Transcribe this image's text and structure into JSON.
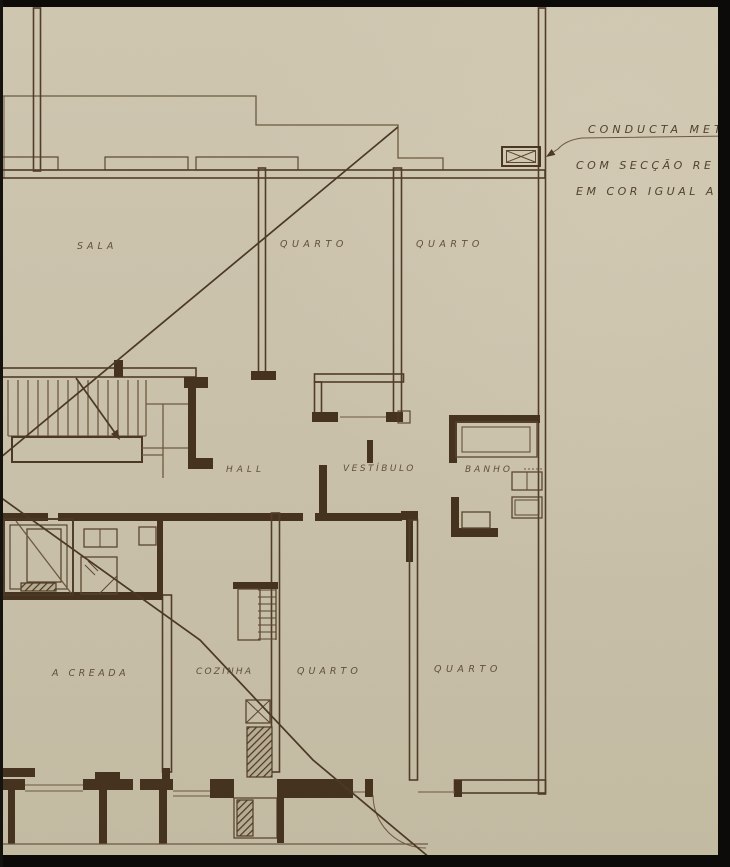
{
  "rooms": [
    {
      "id": "sala",
      "label": "SALA"
    },
    {
      "id": "quarto-top-left",
      "label": "QUARTO"
    },
    {
      "id": "quarto-top-right",
      "label": "QUARTO"
    },
    {
      "id": "hall",
      "label": "HALL"
    },
    {
      "id": "vestibulo",
      "label": "VESTÍBULO"
    },
    {
      "id": "banho",
      "label": "BANHO"
    },
    {
      "id": "quarto-creada",
      "label": "A CREADA"
    },
    {
      "id": "cozinha",
      "label": "COZINHA"
    },
    {
      "id": "quarto-bottom-left",
      "label": "QUARTO"
    },
    {
      "id": "quarto-bottom-right",
      "label": "QUARTO"
    }
  ],
  "annotation": {
    "line1": "CONDUCTA MET",
    "line2": "COM SECÇÃO RE",
    "line3": "EM COR IGUAL A"
  },
  "edge_fragment": "A",
  "colors": {
    "paper": "#cac2ab",
    "paper_light": "#d3cbb4",
    "paper_dark": "#c1b99f",
    "ink": "#5a4733",
    "ink_dark": "#4c3a28",
    "wall": "#503c29",
    "wall_dark": "#46331f",
    "thin": "#6d5940",
    "fixture": "#5a462f",
    "diagonal": "#4b3826",
    "black": "#0c0b09"
  }
}
